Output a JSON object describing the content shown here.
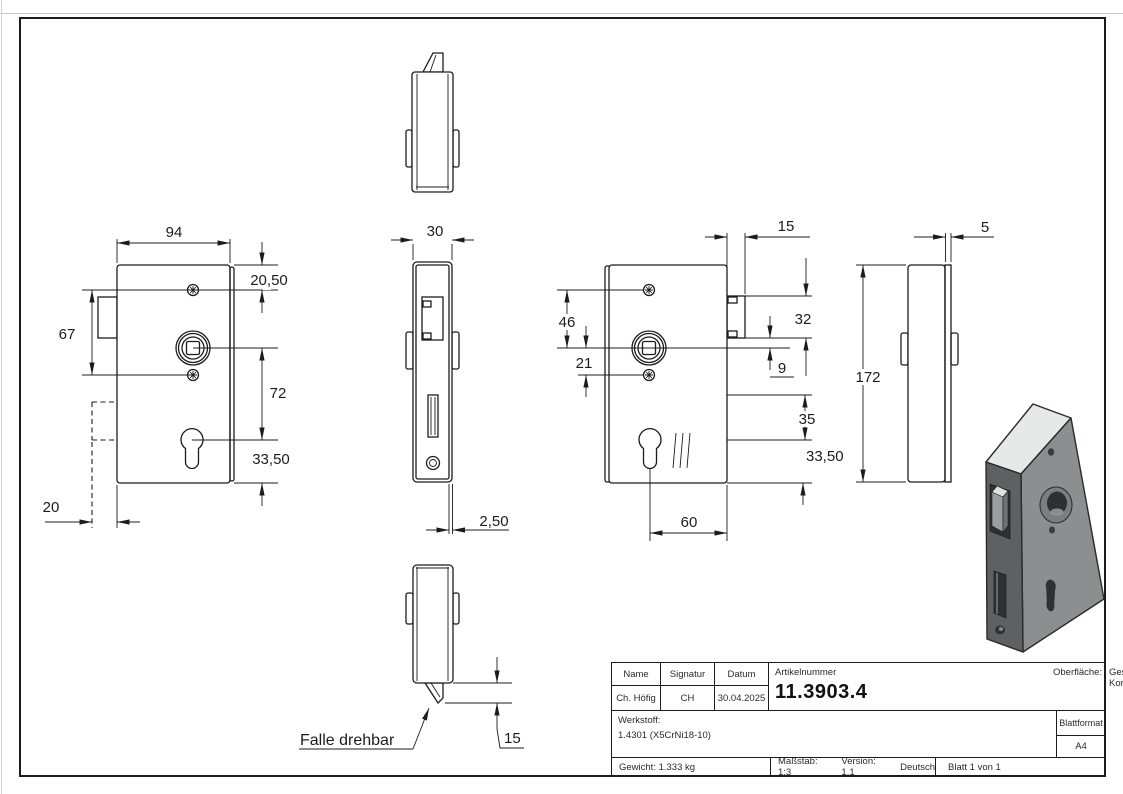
{
  "drawing": {
    "note_falle": "Falle drehbar",
    "dims": {
      "w94": "94",
      "h2050": "20,50",
      "h67": "67",
      "h72": "72",
      "h3350l": "33,50",
      "w20": "20",
      "w30": "30",
      "t250": "2,50",
      "p15b": "15",
      "p15t": "15",
      "h46": "46",
      "h21": "21",
      "h32": "32",
      "h9": "9",
      "h35": "35",
      "h3350r": "33,50",
      "w60": "60",
      "h172": "172",
      "t5": "5"
    }
  },
  "title_block": {
    "labels": {
      "name": "Name",
      "signatur": "Signatur",
      "datum": "Datum",
      "artikelnummer": "Artikelnummer",
      "oberflaeche": "Oberfläche:",
      "werkstoff": "Werkstoff:",
      "blattformat": "Blattformat"
    },
    "values": {
      "name": "Ch. Höfig",
      "signatur": "CH",
      "datum": "30.04.2025",
      "artikelnummer": "11.3903.4",
      "oberflaeche": "Geschliffen Korn 240",
      "werkstoff": "1.4301 (X5CrNi18-10)",
      "blattformat": "A4",
      "gewicht": "Gewicht: 1.333 kg",
      "massstab": "Maßstab: 1:3",
      "version": "Version: 1.1",
      "sprache": "Deutsch",
      "blatt": "Blatt 1 von 1"
    }
  }
}
